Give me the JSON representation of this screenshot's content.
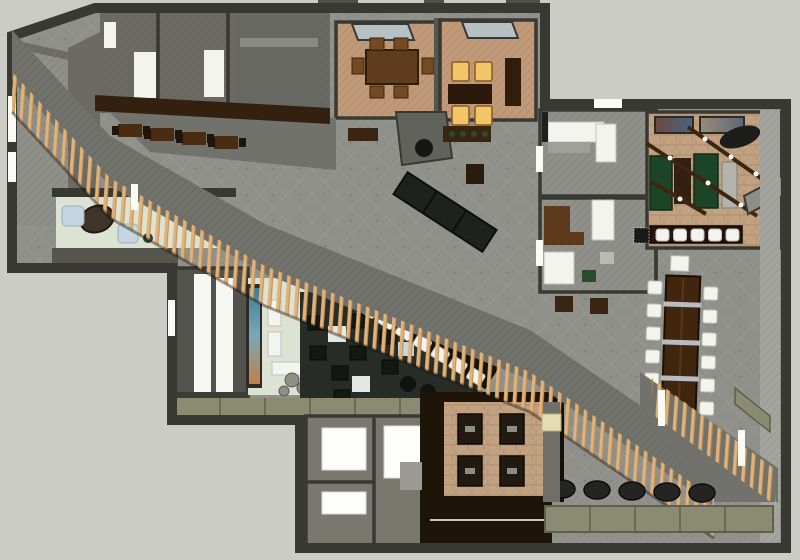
{
  "palette": {
    "background": "#cbccc6",
    "wallDark": "#393934",
    "wallMid": "#56554e",
    "wallLight": "#90908a",
    "wallFiller": "#6b6a63",
    "hallFloor": "#8f908a",
    "carpet": "#71726c",
    "timber": "#e3b277",
    "timberShade": "#bb8c55",
    "mint": "#dde3d3",
    "tanCarpet": "#c09a78",
    "brick": "#c2a181",
    "woodFloor": "#1f1408",
    "canopy": "#34200f",
    "tableWood": "#5f3c1d",
    "chairWood": "#754922",
    "tableDark": "#2b1a0c",
    "buffetDark": "#1f211e",
    "glow": "#f3c569",
    "glowTrim": "#8a5a20",
    "green": "#1c4527",
    "lounge": "#282d28",
    "loungeChair": "#131912",
    "whiteFurn": "#f4f4ef",
    "whiteTrim": "#c2c2bb",
    "blueFurn": "#c4d6e1",
    "olive": "#8b8b71",
    "oliveDark": "#5f5f4c",
    "muralBlue": "#3e7c9e",
    "muralOrange": "#c08045",
    "stool": "#242422",
    "glass": "#b5c1c3",
    "corridor": "#a5a59f",
    "commTable": "#40250f",
    "desk": "#5d3a1c",
    "radiator": "#b3b3ad",
    "rock": "#8f8f88",
    "lightPost": "#fbfbf5",
    "artA": "#6b4a3f",
    "artB": "#48657f"
  },
  "inventory": {
    "barStools": 5,
    "communalChairsLeft": 6,
    "communalChairsRight": 6,
    "banquetteSeats": 7,
    "banquetteTables": 6,
    "ottomans": 5,
    "glowChairsTopRow": 2,
    "glowChairsBottomRow": 2,
    "boothSeatsTopRow": 2,
    "boothSeatsBottomRow": 2,
    "canopyTables": 4
  },
  "regions": [
    "back-of-house",
    "stair-room",
    "entry-vestibule",
    "mural-gallery",
    "lounge",
    "main-hall",
    "private-dining-1",
    "private-dining-2",
    "kitchen-pass",
    "office-1",
    "office-2",
    "billiards-bar",
    "communal-dining",
    "restrooms",
    "booth-dining",
    "terrace",
    "timber-screen"
  ]
}
